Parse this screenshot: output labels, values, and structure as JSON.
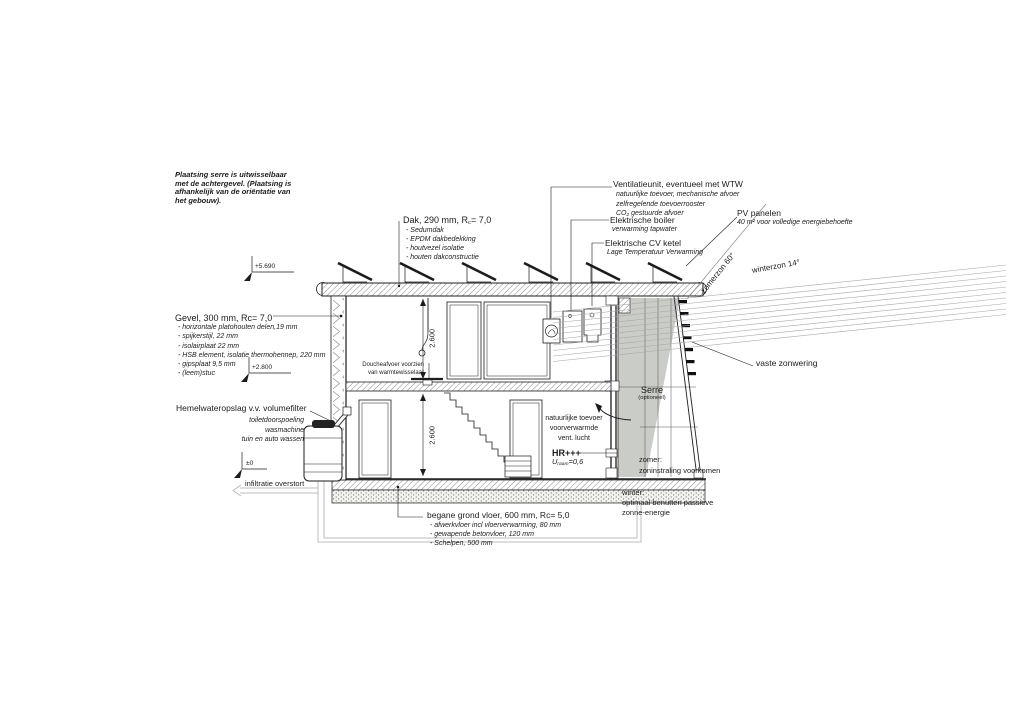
{
  "colors": {
    "line": "#1c1c1c",
    "shadow_fill": "#c9ccc7",
    "sun_ray": "#a9a9a9",
    "pipe": "#bcbcbc"
  },
  "note": {
    "lines": [
      "Plaatsing serre is uitwisselbaar",
      "met de achtergevel. (Plaatsing is",
      "afhankelijk van de oriëntatie van",
      "het gebouw)."
    ]
  },
  "roof_label": {
    "title_pre": "Dak, 290 mm, R",
    "title_sub": "c",
    "title_post": "= 7,0",
    "items": [
      "- Sedumdak",
      "- EPDM dakbedekking",
      "- houtvezel isolatie",
      "- houten dakconstructie"
    ]
  },
  "ventilation_label": {
    "title": "Ventilatieunit, eventueel met WTW",
    "items": [
      "natuurlijke toevoer, mechanische afvoer",
      "zelfregelende toevoerrooster",
      "CO₂ gestuurde afvoer"
    ]
  },
  "boiler_label": {
    "title": "Elektrische boiler",
    "subtitle": "verwarming tapwater"
  },
  "cv_label": {
    "title": "Elektrische CV ketel",
    "subtitle": "Lage Temperatuur Verwarming"
  },
  "pv_label": {
    "title": "PV panelen",
    "subtitle": "40 m² voor volledige energiebehoefte"
  },
  "facade_label": {
    "title": "Gevel, 300 mm, Rc= 7,0",
    "items": [
      "- horizontale platohouten delen,19 mm",
      "- spijkerstijl, 22 mm",
      "- isolairplaat 22 mm",
      "- HSB element, isolatie thermohennep, 220 mm",
      "- gipsplaat 9,5 mm",
      "- (leem)stuc"
    ]
  },
  "rainwater_label": {
    "title": "Hemelwateropslag v.v. volumefilter",
    "items": [
      "toiletdoorspoeling",
      "wasmachine",
      "tuin en auto wassen"
    ]
  },
  "ground_floor_label": {
    "title": "begane grond vloer, 600 mm, Rc= 5,0",
    "items": [
      "- afwerkvloer incl vloerverwarming, 80 mm",
      "- gewapende betonvloer, 120 mm",
      "- Schelpen, 500 mm"
    ]
  },
  "shower_label": {
    "lines": [
      "Doucheafvoer voorzien",
      "van warmtewisselaar"
    ]
  },
  "sunshade_label": "vaste zonwering",
  "serre_label": {
    "title": "Serre",
    "subtitle": "(optioneel)"
  },
  "air_supply_label": {
    "lines": [
      "natuurlijke toevoer",
      "voorverwarmde",
      "vent. lucht"
    ]
  },
  "hr_label": {
    "title": "HR+++",
    "u_pre": "U",
    "u_sub": "raam",
    "u_post": "=0,6"
  },
  "summer_note": {
    "lines": [
      "zomer:",
      "zoninstraling voorkomen"
    ]
  },
  "winter_note": {
    "lines": [
      "winter:",
      "optimaal benutten passieve",
      "zonne-energie"
    ]
  },
  "infiltration_label": "infiltratie overstort",
  "sun_labels": {
    "summer": "zomerzon 60°",
    "winter": "winterzon 14°"
  },
  "elevation_markers": {
    "roof": "+5.690",
    "first_floor": "+2.800",
    "ground": "±0"
  },
  "dimensions": {
    "upper_floor_height": "2.600",
    "ground_floor_height": "2.600"
  }
}
